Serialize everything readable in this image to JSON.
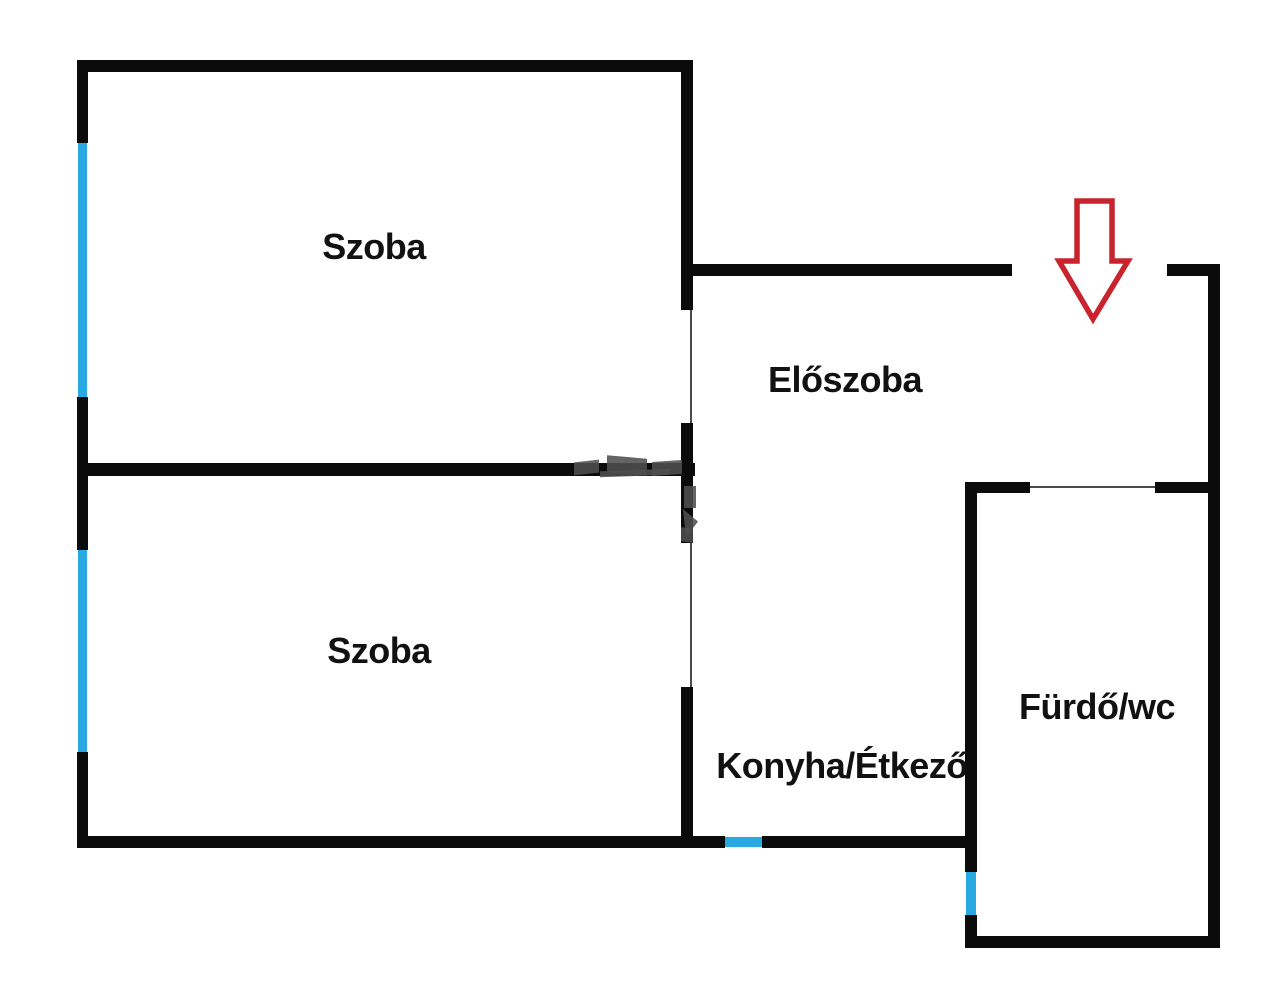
{
  "title": "Floor plan",
  "plan": {
    "width": 1280,
    "height": 1001,
    "colors": {
      "bg": "#ffffff",
      "wall": "#0b0b0b",
      "window": "#29a9e1",
      "doorline": "#4a4a4a",
      "arrow": "#c9242e",
      "label": "#111111",
      "watermark": "#4f4f4f"
    },
    "rooms": [
      {
        "id": "szoba-top",
        "label": "Szoba",
        "cx": 374,
        "cy": 247
      },
      {
        "id": "szoba-bottom",
        "label": "Szoba",
        "cx": 379,
        "cy": 651
      },
      {
        "id": "eloszoba",
        "label": "Előszoba",
        "cx": 845,
        "cy": 380
      },
      {
        "id": "konyha",
        "label": "Konyha/Étkező",
        "cx": 842,
        "cy": 766
      },
      {
        "id": "furdo",
        "label": "Fürdő/wc",
        "cx": 1097,
        "cy": 707
      }
    ],
    "walls": [
      {
        "name": "top-wall",
        "x": 77,
        "y": 60,
        "w": 616,
        "h": 12
      },
      {
        "name": "left-wall-upper",
        "x": 77,
        "y": 60,
        "w": 11,
        "h": 83
      },
      {
        "name": "left-wall-middle",
        "x": 77,
        "y": 397,
        "w": 11,
        "h": 153
      },
      {
        "name": "left-wall-lower",
        "x": 77,
        "y": 752,
        "w": 11,
        "h": 96
      },
      {
        "name": "middle-wall",
        "x": 77,
        "y": 463,
        "w": 618,
        "h": 13
      },
      {
        "name": "divider-wall-top",
        "x": 681,
        "y": 60,
        "w": 12,
        "h": 250
      },
      {
        "name": "divider-wall-mid",
        "x": 681,
        "y": 423,
        "w": 12,
        "h": 120
      },
      {
        "name": "divider-wall-bottom",
        "x": 681,
        "y": 687,
        "w": 12,
        "h": 161
      },
      {
        "name": "bottom-wall-left",
        "x": 77,
        "y": 836,
        "w": 648,
        "h": 12
      },
      {
        "name": "bottom-wall-right",
        "x": 762,
        "y": 836,
        "w": 215,
        "h": 12
      },
      {
        "name": "hall-top-wall",
        "x": 687,
        "y": 264,
        "w": 325,
        "h": 12
      },
      {
        "name": "hall-top-wall-right",
        "x": 1167,
        "y": 264,
        "w": 53,
        "h": 12
      },
      {
        "name": "right-outer-wall",
        "x": 1208,
        "y": 264,
        "w": 12,
        "h": 684
      },
      {
        "name": "bath-top-wall-left",
        "x": 965,
        "y": 482,
        "w": 65,
        "h": 11
      },
      {
        "name": "bath-top-wall-right",
        "x": 1155,
        "y": 482,
        "w": 53,
        "h": 11
      },
      {
        "name": "bath-left-wall",
        "x": 965,
        "y": 482,
        "w": 12,
        "h": 390
      },
      {
        "name": "bath-left-wall-low",
        "x": 965,
        "y": 915,
        "w": 12,
        "h": 33
      },
      {
        "name": "bath-bottom-wall",
        "x": 965,
        "y": 936,
        "w": 255,
        "h": 12
      }
    ],
    "windows": [
      {
        "name": "window-szoba-top",
        "x": 78,
        "y": 143,
        "w": 9,
        "h": 254
      },
      {
        "name": "window-szoba-bottom",
        "x": 78,
        "y": 550,
        "w": 9,
        "h": 202
      },
      {
        "name": "window-konyha",
        "x": 725,
        "y": 837,
        "w": 37,
        "h": 10
      },
      {
        "name": "window-furdo",
        "x": 966,
        "y": 872,
        "w": 10,
        "h": 43
      }
    ],
    "door_openings": [
      {
        "name": "door-line-szoba-top",
        "x": 690,
        "y": 310,
        "w": 2,
        "h": 113
      },
      {
        "name": "door-line-szoba-bottom",
        "x": 690,
        "y": 543,
        "w": 2,
        "h": 144
      },
      {
        "name": "door-line-furdo",
        "x": 1030,
        "y": 486,
        "w": 125,
        "h": 2
      }
    ],
    "watermark_fragments": [
      {
        "x": 574,
        "y": 461,
        "w": 25,
        "h": 13,
        "skew": -6
      },
      {
        "x": 607,
        "y": 457,
        "w": 40,
        "h": 17,
        "skew": 5
      },
      {
        "x": 652,
        "y": 461,
        "w": 30,
        "h": 14,
        "skew": -4
      },
      {
        "x": 600,
        "y": 470,
        "w": 70,
        "h": 6,
        "skew": -2
      },
      {
        "x": 684,
        "y": 486,
        "w": 12,
        "h": 22,
        "skew": 0
      },
      {
        "x": 683,
        "y": 509,
        "w": 15,
        "h": 28,
        "clip": "polygon(0 0, 100% 45%, 20% 100%)"
      },
      {
        "x": 681,
        "y": 528,
        "w": 12,
        "h": 14,
        "skew": 8
      }
    ],
    "arrow": {
      "name": "entrance-arrow",
      "points": "1077,201 1112,201 1112,261 1128,261 1093,319 1059,261 1077,261",
      "stroke_width": 5.5
    }
  }
}
